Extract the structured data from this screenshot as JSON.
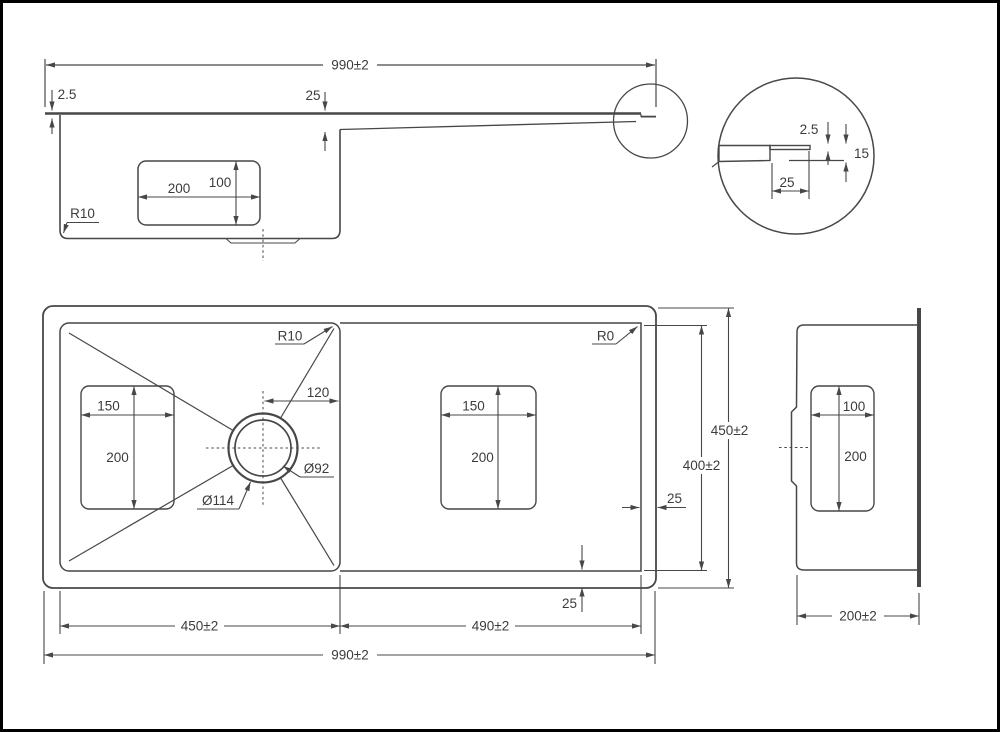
{
  "colors": {
    "line": "#474747",
    "text": "#3c3c3c",
    "background": "#ffffff",
    "border": "#000000"
  },
  "side_view": {
    "total_width": "990±2",
    "rim_thickness": "2.5",
    "drainboard_drop": "25",
    "drain_zone_length": "200",
    "drain_zone_depth": "100",
    "bottom_corner_radius": "R10"
  },
  "edge_detail": {
    "rim_thickness": "2.5",
    "edge_height": "15",
    "edge_inset": "25"
  },
  "plan_view": {
    "bowl_corner_radius": "R10",
    "drainboard_corner_radius": "R0",
    "drain_center_offset": "120",
    "bowl_zone_width": "150",
    "bowl_zone_length": "200",
    "drain_outer_diameter": "Ø114",
    "drain_inner_diameter": "Ø92",
    "board_zone_width": "150",
    "board_zone_length": "200",
    "outer_depth": "450±2",
    "inner_depth": "400±2",
    "rim_width_right": "25",
    "rim_width_bottom": "25",
    "bowl_width": "450±2",
    "drainboard_width": "490±2",
    "total_width": "990±2"
  },
  "end_view": {
    "zone_width": "100",
    "zone_depth": "200",
    "overall_depth": "200±2"
  }
}
